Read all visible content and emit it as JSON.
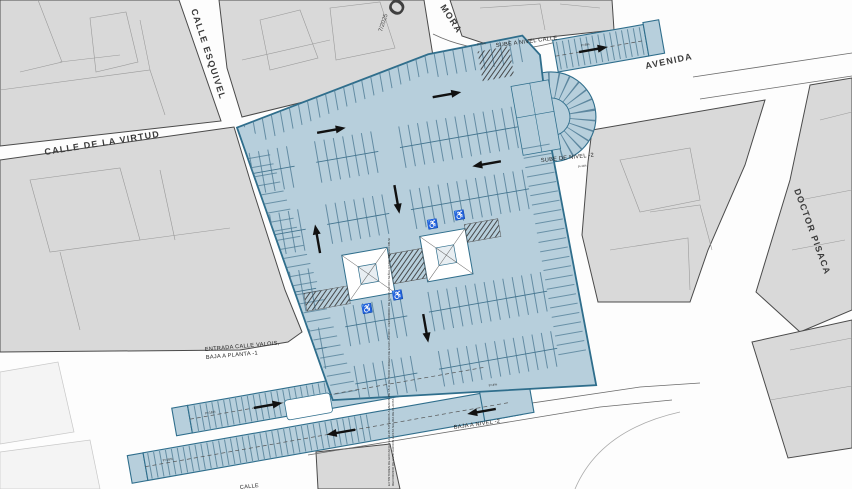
{
  "colors": {
    "parking_fill": "#b7cfdc",
    "parking_stroke": "#2f6e8c",
    "stall_tick": "#4d7a94",
    "building_fill": "#d9d9d9",
    "building_stroke": "#4a4a4a",
    "accessible_blue": "#1a24cc"
  },
  "streets": {
    "esquivel": "CALLE ESQUIVEL",
    "virtud": "CALLE DE LA VIRTUD",
    "mora": "MORA",
    "avenida": "AVENIDA",
    "pisaca": "DOCTOR PISACA",
    "bottom_fragment": "CALLE"
  },
  "annotations": {
    "sube_calle": "SUBE A NIVEL CALLE",
    "sube_niv2": "SUBE DE NIVEL -2",
    "entrada_l1": "ENTRADA CALLE VALOIS,",
    "entrada_l2": "BAJA A PLANTA -1",
    "baja_niv2": "BAJA A NIVEL -2"
  },
  "stamp": {
    "letter": "O",
    "date": "7/2025"
  },
  "ramp_labels": {
    "ne": "P=6%",
    "stub": "P=4%",
    "horseshoe": "P=4%",
    "ramp_a": "P=16%",
    "ramp_b": "P=16%",
    "conn": "P=4%"
  },
  "fire_note_1": "EXTINTORES DE EFICACIA 21A-113B SITUADOS A MENOS DE 15 m DE TODO ORIGEN DE EVACUACION - RECORRIDO DE EVACUACION SEÑALIZADO SEGUN DB-SI",
  "fire_note_2": "RECORRIDO DE EVACUACION HASTA SALIDA DE PLANTA",
  "symbols": {
    "wheelchair": "♿"
  }
}
